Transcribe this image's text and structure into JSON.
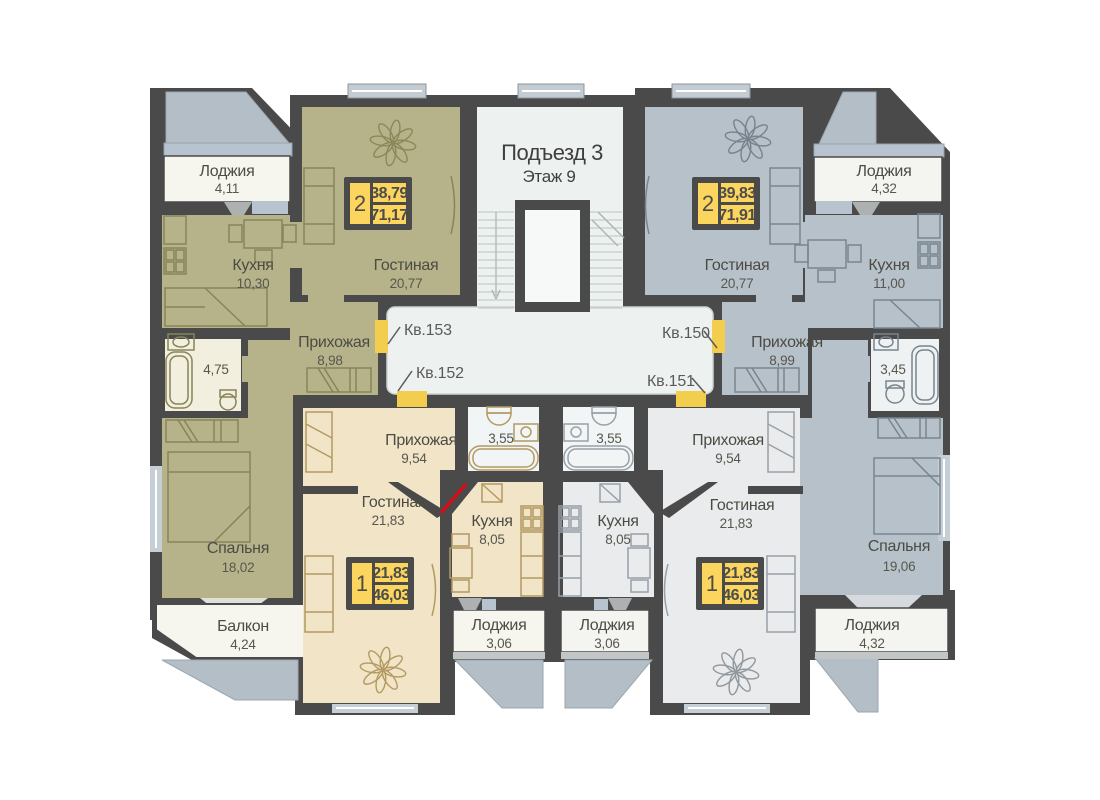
{
  "title": {
    "entrance": "Подъезд 3",
    "floor": "Этаж 9"
  },
  "corridor_labels": {
    "kv153": "Кв.153",
    "kv152": "Кв.152",
    "kv150": "Кв.150",
    "kv151": "Кв.151"
  },
  "apartments": {
    "kv153": {
      "number": "Кв.153",
      "badge": {
        "rooms": "2",
        "area_living": "38,79",
        "area_total": "71,17"
      },
      "rooms": {
        "loggia": {
          "name": "Лоджия",
          "area": "4,11"
        },
        "kitchen": {
          "name": "Кухня",
          "area": "10,30"
        },
        "living": {
          "name": "Гостиная",
          "area": "20,77"
        },
        "hall": {
          "name": "Прихожая",
          "area": "8,98"
        },
        "bathroom": {
          "area": "4,75"
        },
        "bedroom": {
          "name": "Спальня",
          "area": "18,02"
        },
        "balcony": {
          "name": "Балкон",
          "area": "4,24"
        }
      }
    },
    "kv150": {
      "number": "Кв.150",
      "badge": {
        "rooms": "2",
        "area_living": "39,83",
        "area_total": "71,91"
      },
      "rooms": {
        "living": {
          "name": "Гостиная",
          "area": "20,77"
        },
        "loggia": {
          "name": "Лоджия",
          "area": "4,32"
        },
        "kitchen": {
          "name": "Кухня",
          "area": "11,00"
        },
        "hall": {
          "name": "Прихожая",
          "area": "8,99"
        },
        "bathroom": {
          "area": "3,45"
        },
        "bedroom": {
          "name": "Спальня",
          "area": "19,06"
        },
        "loggia2": {
          "name": "Лоджия",
          "area": "4,32"
        }
      }
    },
    "kv152": {
      "number": "Кв.152",
      "badge": {
        "rooms": "1",
        "area_living": "21,83",
        "area_total": "46,03"
      },
      "rooms": {
        "hall": {
          "name": "Прихожая",
          "area": "9,54"
        },
        "bathroom": {
          "area": "3,55"
        },
        "kitchen": {
          "name": "Кухня",
          "area": "8,05"
        },
        "living": {
          "name": "Гостиная",
          "area": "21,83"
        },
        "loggia": {
          "name": "Лоджия",
          "area": "3,06"
        }
      }
    },
    "kv151": {
      "number": "Кв.151",
      "badge": {
        "rooms": "1",
        "area_living": "21,83",
        "area_total": "46,03"
      },
      "rooms": {
        "hall": {
          "name": "Прихожая",
          "area": "9,54"
        },
        "bathroom": {
          "area": "3,55"
        },
        "kitchen": {
          "name": "Кухня",
          "area": "8,05"
        },
        "living": {
          "name": "Гостиная",
          "area": "21,83"
        },
        "loggia": {
          "name": "Лоджия",
          "area": "3,06"
        }
      }
    }
  },
  "colors": {
    "walls": "#4a4a4a",
    "apartment_olive": "#b6b38a",
    "apartment_blue": "#b7c1ca",
    "apartment_beige": "#f2e4c6",
    "apartment_gray": "#e9ebec",
    "corridor": "#edf1ef",
    "loggia_white": "#f7f6ee",
    "bath_cream": "#f2efdf",
    "bath_white": "#f2f5f5",
    "badge_yellow": "#fbd55e",
    "door_yellow": "#f3cd4d",
    "accent_red": "#e30613",
    "awning": "#b4bec7",
    "window": "#c6cfd6"
  }
}
